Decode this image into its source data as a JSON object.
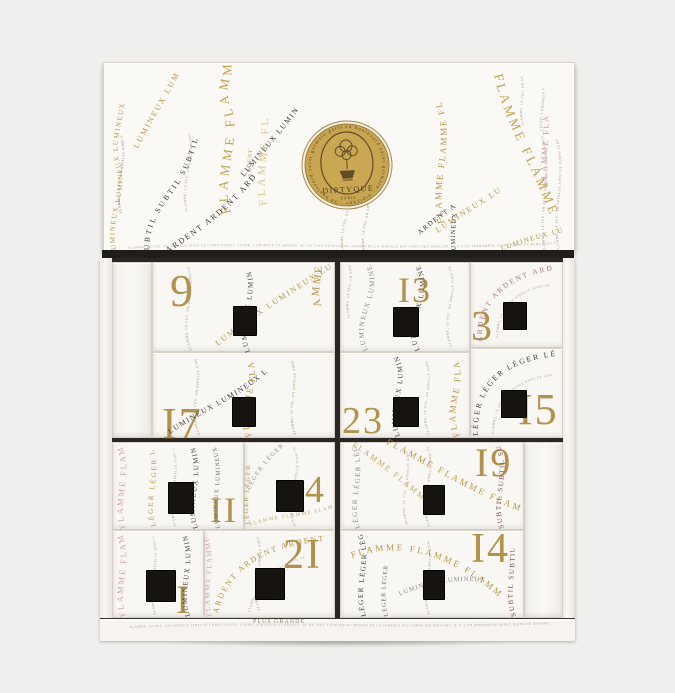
{
  "product": {
    "name": "Advent calendar box",
    "brand": "DIPTYQUE",
    "city": "PARIS"
  },
  "logo": {
    "brand": "DIPTYQUE",
    "city": "PARIS",
    "ring_text": "34 boulevard saint germain · diptyque · 34 boulevard saint germain paris"
  },
  "lid_words": [
    "FLAMME",
    "LUMINEUX",
    "SUBTIL",
    "ARDENT",
    "LÉGER"
  ],
  "micro_text": "FLAMME, LE FEU. ON APPELLE AINSI CE CORPS SUBTIL, LÉGER, LUMINEUX ET ARDENT, QU'ON VOIT S'ÉLEVER AU-DESSUS DE LA SURFACE DES CORPS QUI BRÛLENT. IL Y A UN PHÉNOMÈNE ASSEZ DIGNE DE REMARQUE SUR LA FLAMME D'UNE CHANDELLE, D'UN FLAMBEAU, OU DE QUELQUE AUTRE CHOSE SEMBLABLE, QUI BRILLE PLUS GRANDE.",
  "base": {
    "text": "PLUS GRANDE"
  },
  "drawers": [
    {
      "number": 9,
      "display": "9"
    },
    {
      "number": 17,
      "display": "I7"
    },
    {
      "number": 13,
      "display": "I3"
    },
    {
      "number": 23,
      "display": "23"
    },
    {
      "number": 3,
      "display": "3"
    },
    {
      "number": 15,
      "display": "I5"
    },
    {
      "number": 11,
      "display": "II"
    },
    {
      "number": 4,
      "display": "4"
    },
    {
      "number": 19,
      "display": "I9"
    },
    {
      "number": 1,
      "display": "I"
    },
    {
      "number": 21,
      "display": "2I"
    },
    {
      "number": 14,
      "display": "I4"
    }
  ],
  "colors": {
    "background": "#f0efed",
    "box_white": "#f9f7f3",
    "gap_dark": "#2b2623",
    "numeral_gold": "#b2914b",
    "gold": "#b5974c",
    "pale_gold": "#ddc98f",
    "pink": "#d5a3aa",
    "mauve": "#a8798b",
    "dark_red": "#7a4a58",
    "olive": "#8f8a55",
    "gray_purple": "#8e8691",
    "ink": "#3a3632",
    "micro_gray": "#9a9288",
    "logo_gold": "#c8a551"
  },
  "decor": {
    "lid": [
      {
        "path": "l1",
        "text": "LUMINEUX LUMINEUX LUMINEUX",
        "color": "#b5974c",
        "size": 7,
        "spacing": 1.5
      },
      {
        "path": "l2",
        "text": "LUMINEUX LUMINEUX",
        "color": "#b5974c",
        "size": 8,
        "spacing": 2
      },
      {
        "path": "l3",
        "text": "SUBTIL SUBTIL SUBTIL",
        "color": "#3a3632",
        "size": 7.5,
        "spacing": 2.5
      },
      {
        "path": "l4",
        "micro": true,
        "color": "#b48a92",
        "size": 3.4
      },
      {
        "path": "l5",
        "micro": true,
        "color": "#6b6660",
        "size": 3.2
      },
      {
        "path": "l6",
        "text": "FLAMME FLAMME",
        "color": "#c2a253",
        "size": 13,
        "spacing": 4
      },
      {
        "path": "l7",
        "text": "ARDENT ARDENT ARDENT",
        "color": "#3a3632",
        "size": 8,
        "spacing": 2
      },
      {
        "path": "l8",
        "text": "LUMINEUX LUMINE",
        "color": "#3a3632",
        "size": 7.5,
        "spacing": 1.5
      },
      {
        "path": "l9",
        "text": "FLAMME FL",
        "color": "#ddc98f",
        "size": 11,
        "spacing": 3
      },
      {
        "path": "l10",
        "text": "ARDENT",
        "color": "#b5974c",
        "size": 5.5,
        "spacing": 1
      },
      {
        "path": "l11",
        "micro": true,
        "color": "#8f8a55",
        "size": 3.2
      },
      {
        "path": "l11b",
        "micro": true,
        "color": "#8f8a55",
        "size": 3.2
      },
      {
        "path": "l12",
        "text": "FLAMME FLAMME FL",
        "color": "#b5974c",
        "size": 9,
        "spacing": 2
      },
      {
        "path": "l13",
        "text": "FLAMME FLAMME",
        "color": "#c2a253",
        "size": 13,
        "spacing": 3
      },
      {
        "path": "l14",
        "text": "LUMINEUX LUMINE",
        "color": "#b5974c",
        "size": 8,
        "spacing": 2
      },
      {
        "path": "l15",
        "text": "ARDENT ARDENT",
        "color": "#3a3632",
        "size": 7,
        "spacing": 1.5
      },
      {
        "path": "l16",
        "text": "LUMINEUX",
        "color": "#3a3632",
        "size": 6.5,
        "spacing": 1
      },
      {
        "path": "l17",
        "micro": true,
        "color": "#9a9288",
        "size": 3.4
      },
      {
        "path": "l17b",
        "micro": true,
        "color": "#9a9288",
        "size": 3.4
      },
      {
        "path": "l18",
        "text": "FLAMME FLA",
        "color": "#c49aa4",
        "size": 8,
        "spacing": 2
      },
      {
        "path": "l19",
        "micro": true,
        "color": "#9a9288",
        "size": 3.2
      },
      {
        "path": "l20",
        "text": "LUMINEUX LUMINE",
        "color": "#b5974c",
        "size": 7,
        "spacing": 1.5
      },
      {
        "path": "l21",
        "micro": true,
        "color": "#a29a8e",
        "size": 3
      }
    ],
    "cabinet": [
      {
        "path": "c1",
        "micro": true,
        "color": "#9a9288",
        "size": 3.4
      },
      {
        "path": "c2",
        "text": "LUMINEUX LUMINEUX LUMINEUX",
        "color": "#b5974c",
        "size": 8,
        "spacing": 2
      },
      {
        "path": "c3",
        "text": "LUMINEUX LUMINEUX LUMINEUX",
        "color": "#44403a",
        "size": 7,
        "spacing": 1.5
      },
      {
        "path": "c3b",
        "text": "AMME",
        "color": "#b5974c",
        "size": 11,
        "spacing": 2
      },
      {
        "path": "c4",
        "text": "FLAMME FLAMME",
        "color": "#b5974c",
        "size": 9,
        "spacing": 2
      },
      {
        "path": "c5",
        "text": "LUMINEUX LUMINEUX LUMINEUX",
        "color": "#44403a",
        "size": 7.5,
        "spacing": 1.5
      },
      {
        "path": "c6",
        "micro": true,
        "color": "#9a9288",
        "size": 3.4
      },
      {
        "path": "c6b",
        "micro": true,
        "color": "#8f8a55",
        "size": 3.2
      },
      {
        "path": "c7",
        "text": "LUMINEUX LUMINEUX LUMINEUX",
        "color": "#8e8691",
        "size": 7,
        "spacing": 1.5
      },
      {
        "path": "c8",
        "text": "LUMINEUX LUMINEUX LUMINEUX",
        "color": "#44403a",
        "size": 7,
        "spacing": 1.5
      },
      {
        "path": "c9",
        "micro": true,
        "color": "#9a9288",
        "size": 3.2
      },
      {
        "path": "c9b",
        "micro": true,
        "color": "#9a9288",
        "size": 3.2
      },
      {
        "path": "c10",
        "text": "LUMINEUX LUMINEUX LUMINEUX",
        "color": "#44403a",
        "size": 7,
        "spacing": 1.5
      },
      {
        "path": "c11",
        "text": "FLAMME FLAMME",
        "color": "#b5974c",
        "size": 9,
        "spacing": 2
      },
      {
        "path": "c12",
        "micro": true,
        "color": "#9a9288",
        "size": 3.2
      },
      {
        "path": "c13",
        "text": "ARDENT ARDENT ARDENT",
        "color": "#a8798b",
        "size": 7.5,
        "spacing": 2
      },
      {
        "path": "c13b",
        "micro": true,
        "color": "#b48a92",
        "size": 3.2
      },
      {
        "path": "c14",
        "text": "LÉGER LÉGER LÉGER LÉGER",
        "color": "#3a3632",
        "size": 7.5,
        "spacing": 2
      },
      {
        "path": "c14b",
        "micro": true,
        "color": "#9a9288",
        "size": 3.2
      },
      {
        "path": "c15",
        "text": "FLAMME FLAMME",
        "color": "#d5a3aa",
        "size": 8.5,
        "spacing": 2
      },
      {
        "path": "c16",
        "text": "LÉGER LÉGER LÉGER",
        "color": "#b5974c",
        "size": 7,
        "spacing": 2
      },
      {
        "path": "c17",
        "text": "LUMINEUX LUMINEUX LUMINEUX",
        "color": "#44403a",
        "size": 7,
        "spacing": 1.5
      },
      {
        "path": "c17b",
        "text": "LUMINEUX LUMINEUX",
        "color": "#6b6660",
        "size": 6,
        "spacing": 1
      },
      {
        "path": "c18",
        "micro": true,
        "color": "#9a9288",
        "size": 3.2
      },
      {
        "path": "c19",
        "text": "LÉGER LÉGER",
        "color": "#8e8691",
        "size": 6,
        "spacing": 1.5
      },
      {
        "path": "c20",
        "micro": true,
        "color": "#9a9288",
        "size": 3.2
      },
      {
        "path": "c21",
        "text": "FLAMME FLAMME FLAMME",
        "color": "#c2a55e",
        "size": 5,
        "spacing": 1.5
      },
      {
        "path": "c21b",
        "text": "LÉGER LÉGER",
        "color": "#b5974c",
        "size": 6.5,
        "spacing": 1.5
      },
      {
        "path": "c22",
        "text": "FLAMME FLAMME",
        "color": "#d5a3aa",
        "size": 8.5,
        "spacing": 2
      },
      {
        "path": "c23",
        "text": "LUMINEUX LUMINEUX LUMINEUX",
        "color": "#44403a",
        "size": 7,
        "spacing": 1.5
      },
      {
        "path": "c24",
        "micro": true,
        "color": "#9a9288",
        "size": 3.2
      },
      {
        "path": "c25",
        "text": "ARDENT ARDENT ARDENT",
        "color": "#b5974c",
        "size": 8,
        "spacing": 2
      },
      {
        "path": "c26",
        "text": "FLAMME FLAMME",
        "color": "#d5a3aa",
        "size": 7,
        "spacing": 1.5
      },
      {
        "path": "c27",
        "micro": true,
        "color": "#b48a92",
        "size": 3.2
      },
      {
        "path": "c28",
        "micro": true,
        "color": "#9a9288",
        "size": 3.2
      },
      {
        "path": "c29",
        "text": "FLAMME FLAMME FLAMME",
        "color": "#b5974c",
        "size": 9,
        "spacing": 2.5
      },
      {
        "path": "c30",
        "text": "FLAMME FLAMME",
        "color": "#c2a55e",
        "size": 8,
        "spacing": 2
      },
      {
        "path": "c31",
        "text": "SUBTIL SUBTIL SUBTIL",
        "color": "#7a4a58",
        "size": 7,
        "spacing": 1.5
      },
      {
        "path": "c32",
        "text": "LÉGER LÉGER LÉGER",
        "color": "#8e8691",
        "size": 7,
        "spacing": 1.5
      },
      {
        "path": "c33",
        "micro": true,
        "color": "#9a9288",
        "size": 3.2
      },
      {
        "path": "c33b",
        "micro": true,
        "color": "#b48a92",
        "size": 3.2
      },
      {
        "path": "c34",
        "text": "LÉGER LÉGER LÉGER",
        "color": "#3a3632",
        "size": 7,
        "spacing": 1.5
      },
      {
        "path": "c34b",
        "text": "LÉGER LÉGER",
        "color": "#6b6660",
        "size": 6,
        "spacing": 1
      },
      {
        "path": "c35",
        "text": "LUMINEUX LUMINEUX",
        "color": "#8e8691",
        "size": 6.5,
        "spacing": 1
      },
      {
        "path": "c36",
        "text": "FLAMME FLAMME FLAMME",
        "color": "#b5974c",
        "size": 9,
        "spacing": 2.5
      },
      {
        "path": "c37",
        "text": "SUBTIL SUBTIL",
        "color": "#7a4a58",
        "size": 7,
        "spacing": 1.5
      },
      {
        "path": "c38",
        "micro": true,
        "color": "#9a9288",
        "size": 3.2
      },
      {
        "path": "c39",
        "micro": true,
        "color": "#a29a8e",
        "size": 3
      }
    ]
  }
}
